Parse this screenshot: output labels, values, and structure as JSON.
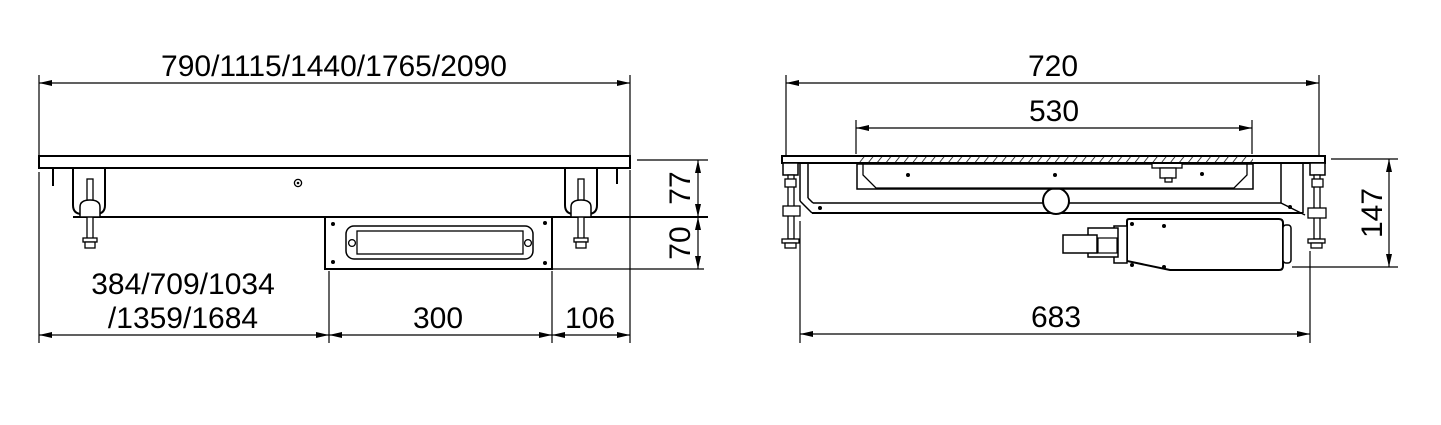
{
  "front_view": {
    "top_width_label": "790/1115/1440/1765/2090",
    "depth_upper_label": "77",
    "depth_lower_label": "70",
    "left_span_label_line1": "384/709/1034",
    "left_span_label_line2": "/1359/1684",
    "drain_box_width_label": "300",
    "right_offset_label": "106"
  },
  "side_view": {
    "top_width_label": "720",
    "opening_width_label": "530",
    "height_label": "147",
    "body_width_label": "683"
  },
  "colors": {
    "line": "#000000",
    "background": "#ffffff"
  }
}
